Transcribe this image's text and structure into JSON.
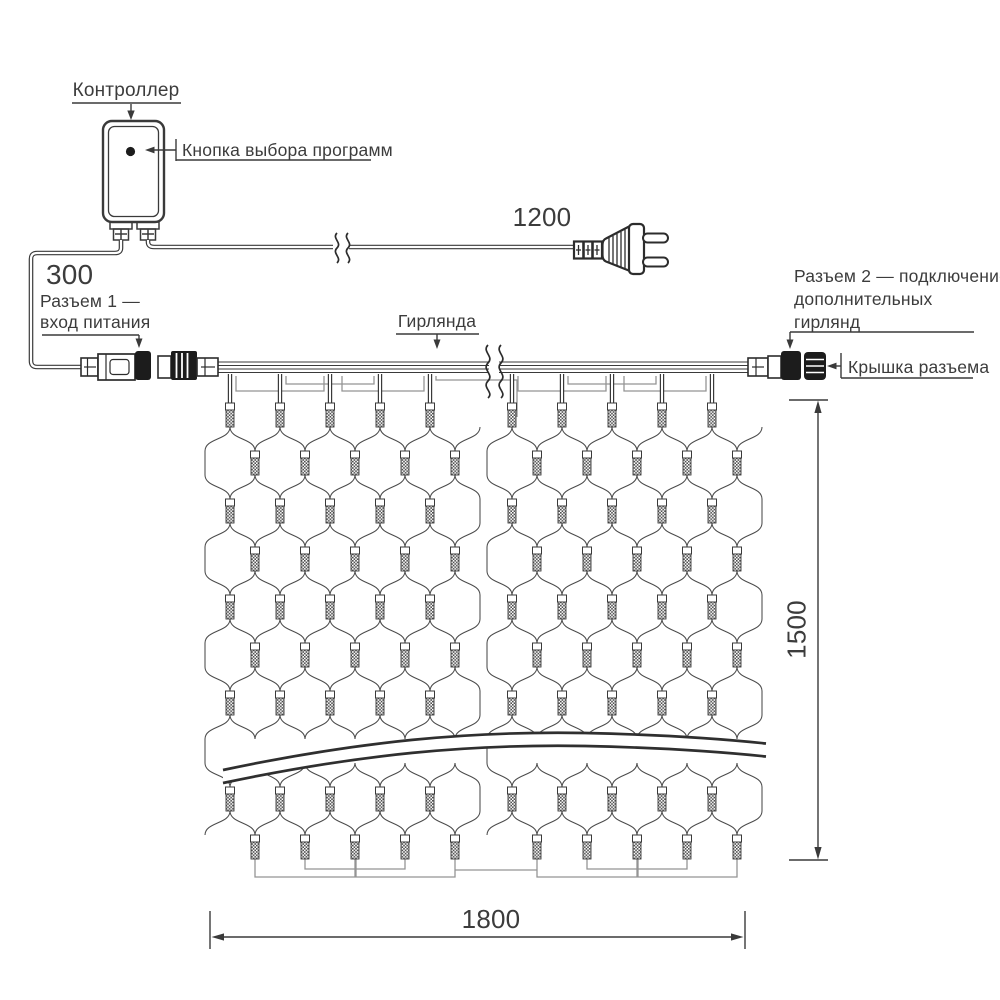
{
  "labels": {
    "controller": "Контроллер",
    "program_button": "Кнопка выбора программ",
    "connector1_title": "Разъем 1 —",
    "connector1_sub": "вход питания",
    "garland": "Гирлянда",
    "connector2_line1": "Разъем 2 — подключение",
    "connector2_line2": "дополнительных",
    "connector2_line3": "гирлянд",
    "connector_cap": "Крышка разъема"
  },
  "dimensions": {
    "power_cord_mm": "1200",
    "power_lead_mm": "300",
    "net_width_mm": "1800",
    "net_height_mm": "1500"
  },
  "net": {
    "rows": 10,
    "row0_y": 415,
    "row_step": 48,
    "node_dx": 25,
    "lamp_hidden_row": 7,
    "drop_top_y": 374,
    "lamp_top_y": 403,
    "bus_x": [
      218,
      748
    ],
    "bus_y": [
      362,
      365.5,
      369,
      372.5
    ],
    "halves": [
      {
        "even": [
          230,
          280,
          330,
          380,
          430
        ],
        "odd": [
          255,
          305,
          355,
          405,
          455
        ],
        "edge_left": 205,
        "edge_right": 480
      },
      {
        "even": [
          512,
          562,
          612,
          662,
          712
        ],
        "odd": [
          537,
          587,
          637,
          687,
          737
        ],
        "edge_left": 487,
        "edge_right": 762
      }
    ]
  },
  "colors": {
    "line": "#3a3a3a",
    "mesh": "#4a4a4a",
    "wire_gray": "#949494",
    "black_fill": "#1c1c1c",
    "rope": "#2f2f2f"
  }
}
